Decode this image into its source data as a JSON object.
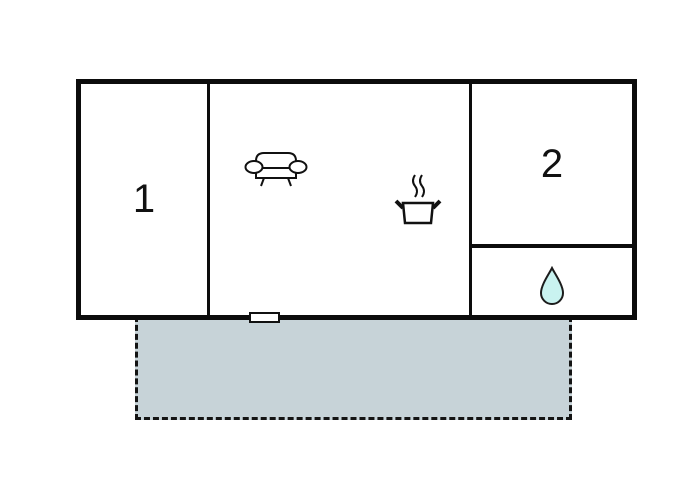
{
  "floor_plan": {
    "type": "vacation-home-floor-plan",
    "rooms": [
      {
        "name": "room-1",
        "label": "1"
      },
      {
        "name": "room-2",
        "label": "2"
      },
      {
        "name": "living-kitchen-room",
        "label": ""
      },
      {
        "name": "bathroom",
        "label": ""
      }
    ],
    "icons": {
      "sofa": "sofa-icon",
      "cooking_pot": "cooking-pot-steam-icon",
      "water_drop": "water-drop-icon"
    },
    "features": {
      "terrace": "dashed-outline-terrace",
      "door": "door-window-marker"
    },
    "colors": {
      "wall": "#0c0c0c",
      "background": "#ffffff",
      "terrace_fill": "#c7d3d8",
      "terrace_border": "#141414",
      "water_drop_fill": "#c9f3f0",
      "icon_stroke": "#111111"
    }
  }
}
